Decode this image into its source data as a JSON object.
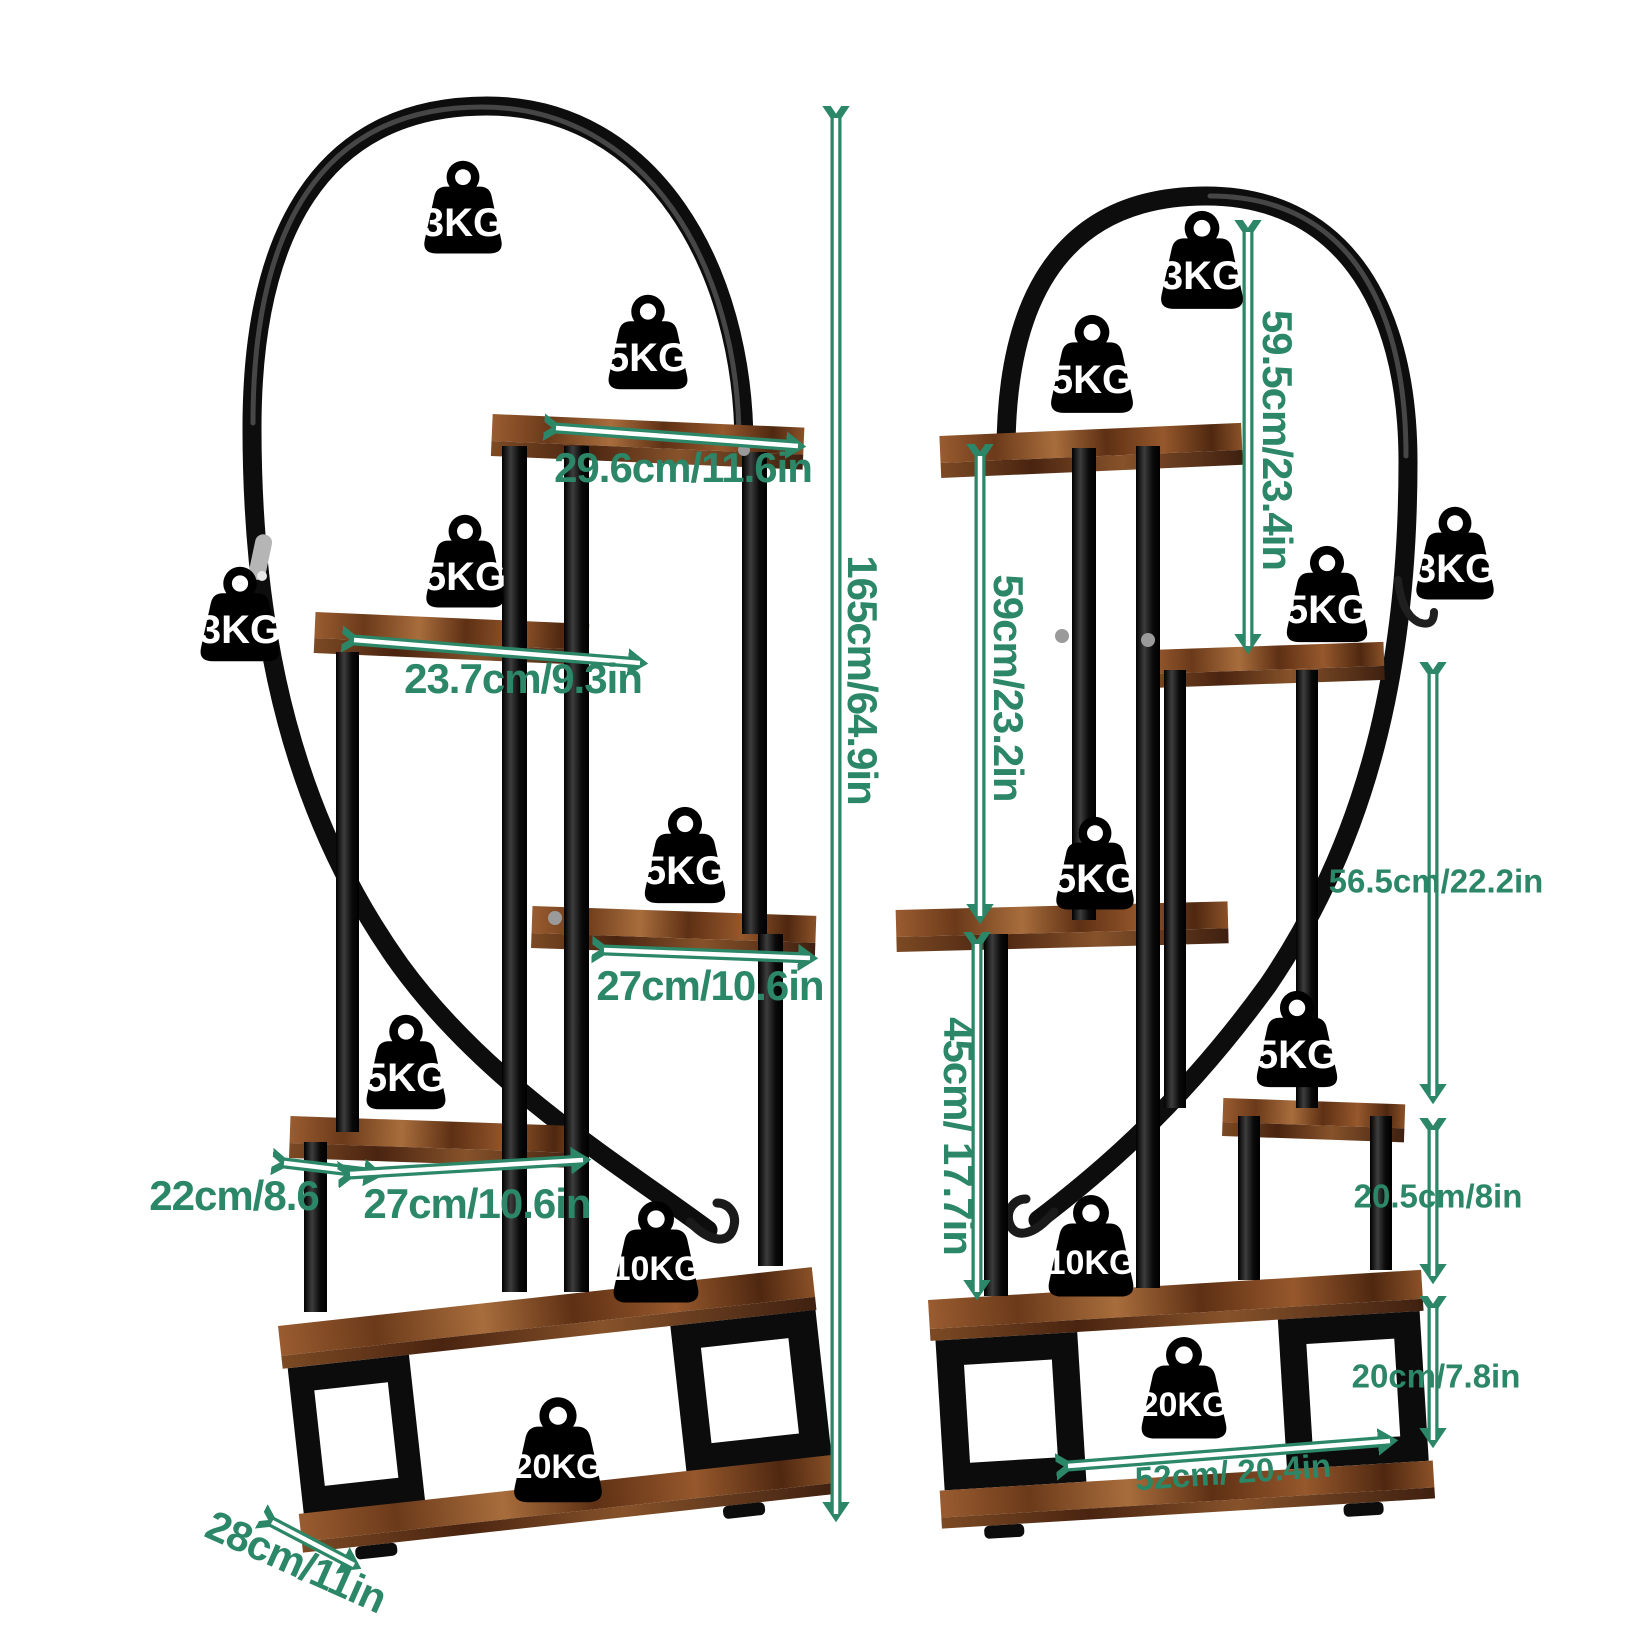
{
  "colors": {
    "background": "#ffffff",
    "accent_green": "#2b8767",
    "metal_black": "#0c0c0c",
    "wood_brown": "#7c4a24",
    "badge_black": "#000000",
    "badge_text": "#ffffff"
  },
  "left_stand": {
    "weights": [
      "3KG",
      "5KG",
      "3KG",
      "5KG",
      "5KG",
      "5KG",
      "10KG",
      "20KG"
    ],
    "dimensions": {
      "top_shelf_width": "29.6cm/11.6in",
      "second_shelf_width": "23.7cm/9.3in",
      "third_shelf_width": "27cm/10.6in",
      "fourth_shelf_depth": "22cm/8.6",
      "fourth_shelf_width": "27cm/10.6in",
      "base_depth": "28cm/11in",
      "total_height": "165cm/64.9in"
    }
  },
  "right_stand": {
    "weights": [
      "3KG",
      "5KG",
      "5KG",
      "3KG",
      "5KG",
      "5KG",
      "10KG",
      "20KG"
    ],
    "dimensions": {
      "arch_drop_height": "59.5cm/23.4in",
      "upper_section_height": "59cm/23.2in",
      "lower_section_height": "45cm/ 17.7in",
      "side_span_height": "56.5cm/22.2in",
      "shelf_gap_height": "20.5cm/8in",
      "base_height": "20cm/7.8in",
      "base_width": "52cm/ 20.4in"
    }
  }
}
